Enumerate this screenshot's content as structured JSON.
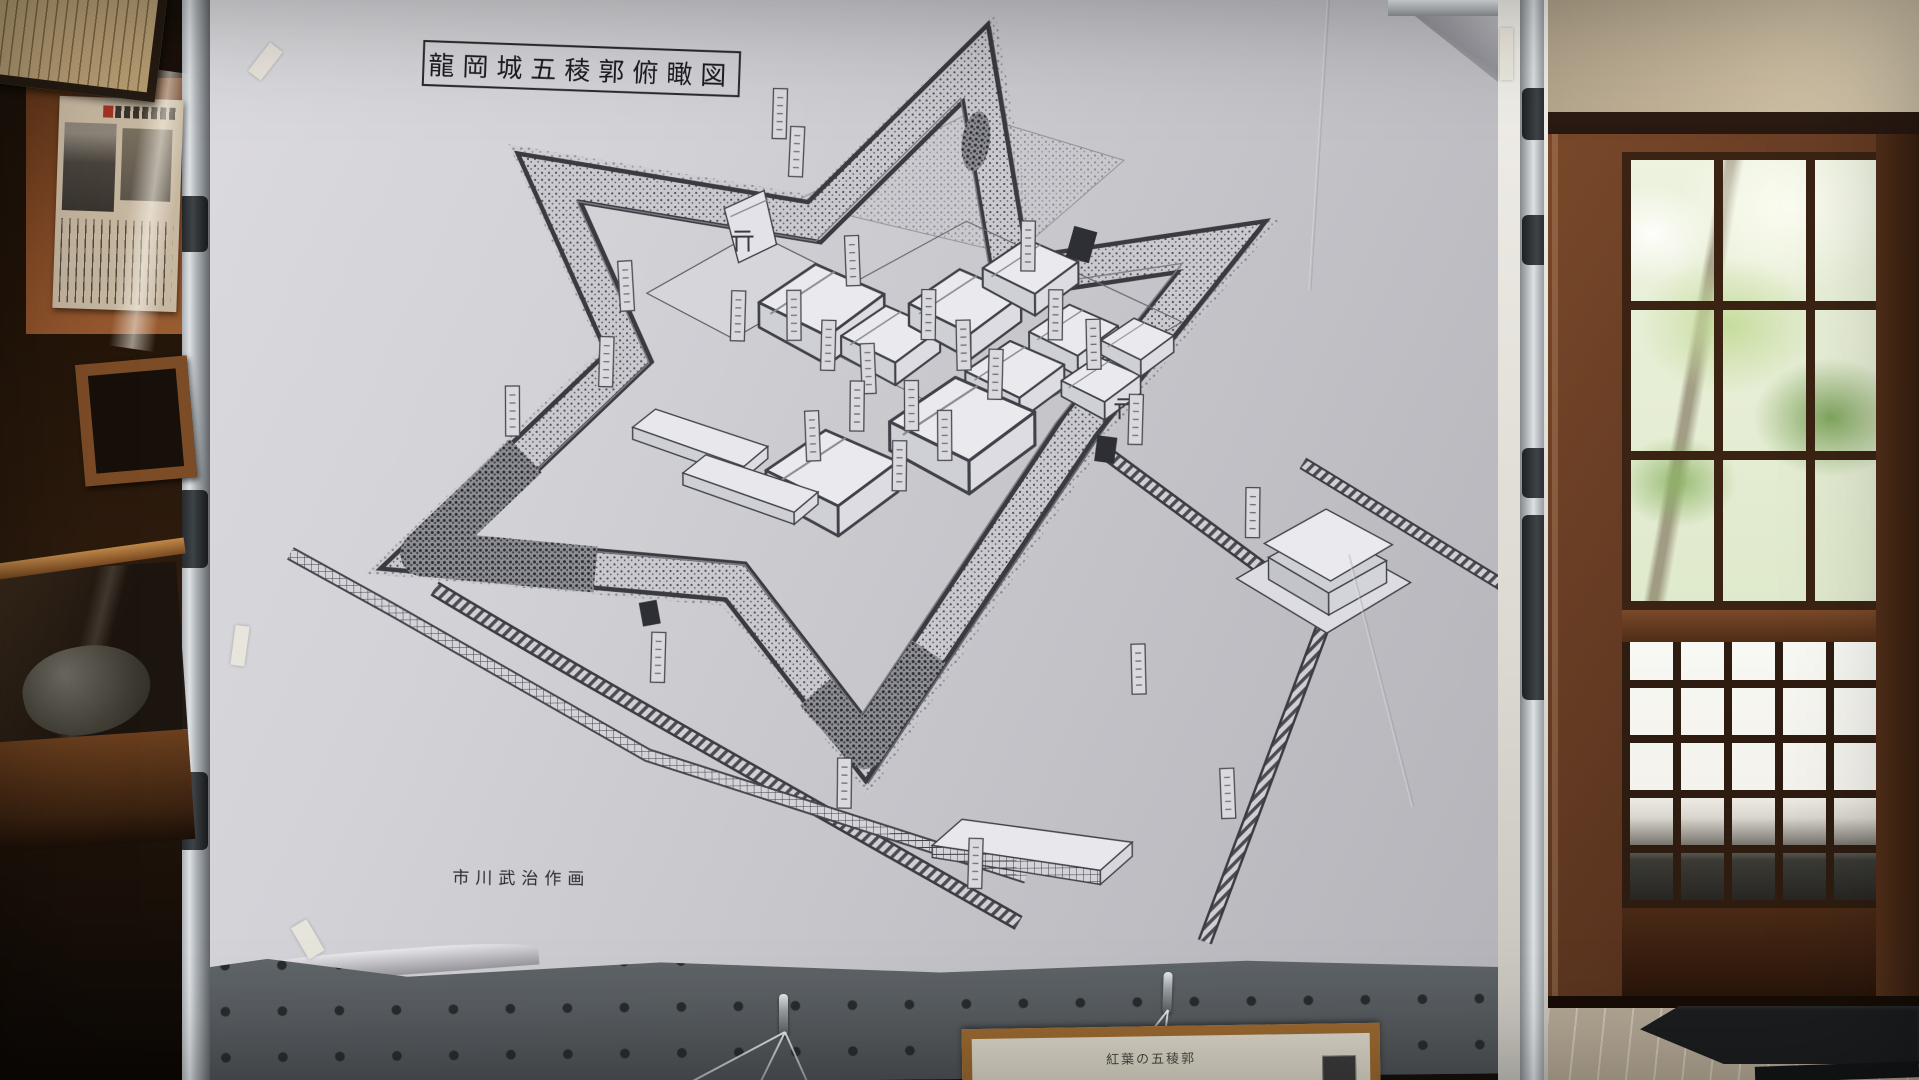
{
  "poster": {
    "title": "龍岡城五稜郭俯瞰図",
    "signature": "市川武治作画"
  },
  "hanging_frame": {
    "caption": "紅葉の五稜郭"
  },
  "colors": {
    "poster_paper": "#cfcfd4",
    "drawing_ink": "#3c3c42",
    "pegboard": "#767c81",
    "door_wood": "#5d3620",
    "foliage_green": "#8fb26a",
    "frame_wood": "#9a6830",
    "newspaper_wall": "#8a4e28"
  }
}
